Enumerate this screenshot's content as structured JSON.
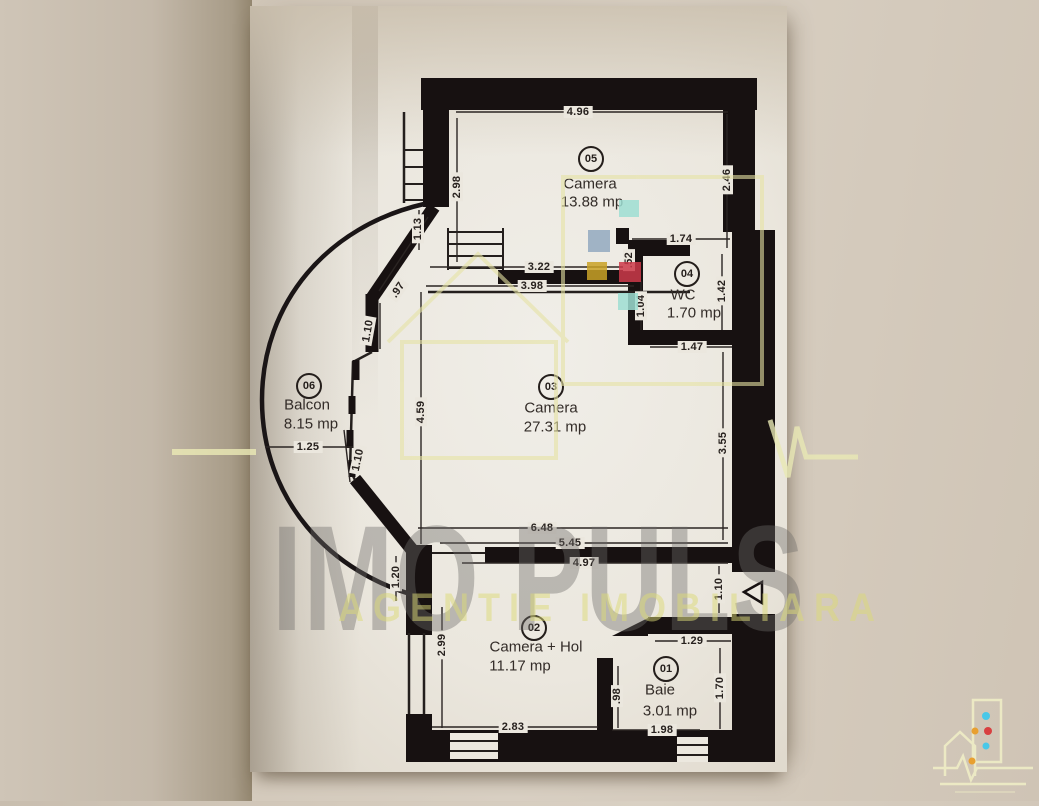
{
  "watermark": {
    "brand": "IMO PULS",
    "tagline": "AGENTIE IMOBILIARA",
    "accent_yellow": "#e6e3a4",
    "square_colors": [
      "#9eded2",
      "#92a9bf",
      "#c9a227",
      "#cc3a4a",
      "#9eded2"
    ]
  },
  "plan": {
    "rooms": [
      {
        "id": "05",
        "name": "Camera",
        "area": "13.88 mp"
      },
      {
        "id": "04",
        "name": "WC",
        "area": "1.70 mp"
      },
      {
        "id": "03",
        "name": "Camera",
        "area": "27.31 mp"
      },
      {
        "id": "06",
        "name": "Balcon",
        "area": "8.15 mp"
      },
      {
        "id": "02",
        "name": "Camera + Hol",
        "area": "11.17 mp"
      },
      {
        "id": "01",
        "name": "Baie",
        "area": "3.01 mp"
      }
    ],
    "dimensions": [
      "4.96",
      "2.98",
      "2.46",
      "1.74",
      ".52",
      "1.42",
      "1.04",
      "1.47",
      "3.22",
      "3.98",
      ".97",
      "1.10",
      "4.59",
      "1.25",
      "1.10",
      "3.55",
      "6.48",
      "5.45",
      "4.97",
      "1.20",
      "2.99",
      "1.10",
      "1.29",
      "1.70",
      ".98",
      "2.83",
      "1.98",
      "1.13"
    ]
  }
}
